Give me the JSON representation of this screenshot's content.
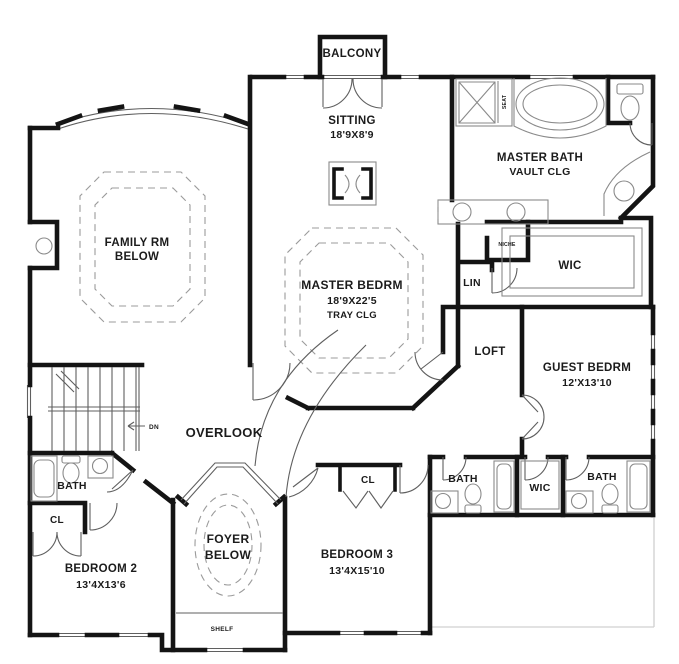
{
  "rooms": {
    "balcony": {
      "label": "BALCONY"
    },
    "sitting": {
      "label": "SITTING",
      "dims": "18'9X8'9"
    },
    "master_bath": {
      "label": "MASTER BATH",
      "ceiling": "VAULT CLG"
    },
    "seat": {
      "label": "SEAT"
    },
    "family_room": {
      "label": "FAMILY RM",
      "note": "BELOW"
    },
    "master_bedroom": {
      "label": "MASTER BEDRM",
      "dims": "18'9X22'5",
      "ceiling": "TRAY CLG"
    },
    "niche": {
      "label": "NICHE"
    },
    "lin": {
      "label": "LIN"
    },
    "wic_master": {
      "label": "WIC"
    },
    "loft": {
      "label": "LOFT"
    },
    "guest_bedroom": {
      "label": "GUEST BEDRM",
      "dims": "12'X13'10"
    },
    "overlook": {
      "label": "OVERLOOK"
    },
    "stairs": {
      "direction": "DN"
    },
    "bath_left": {
      "label": "BATH"
    },
    "closet_left": {
      "label": "CL"
    },
    "bedroom2": {
      "label": "BEDROOM 2",
      "dims": "13'4X13'6"
    },
    "foyer": {
      "label": "FOYER",
      "note": "BELOW"
    },
    "bedroom3": {
      "label": "BEDROOM 3",
      "dims": "13'4X15'10"
    },
    "closet_bedroom3": {
      "label": "CL"
    },
    "bath_hall": {
      "label": "BATH"
    },
    "wic_hall": {
      "label": "WIC"
    },
    "bath_guest": {
      "label": "BATH"
    },
    "shelf": {
      "label": "SHELF"
    }
  },
  "colors": {
    "wall": "#141414",
    "fixture_line": "#8a8a8a",
    "detail_line": "#5f5f5f",
    "dashed_line": "#9b9b9b",
    "text": "#1b1b1b",
    "frame": "#d0d0d0"
  }
}
